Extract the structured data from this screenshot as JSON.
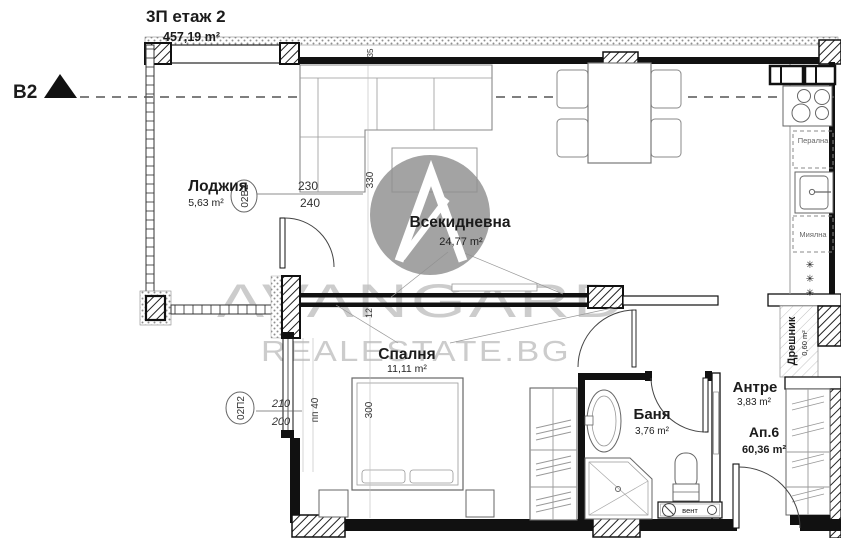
{
  "header": {
    "floor_label": "3П етаж 2",
    "floor_area": "457,19 m²"
  },
  "section_marker": {
    "label": "B2"
  },
  "watermark": {
    "brand": "AVANGARD",
    "site": "REALESTATE.BG"
  },
  "rooms": {
    "loggia": {
      "name": "Лоджия",
      "area": "5,63 m²"
    },
    "living": {
      "name": "Всекидневна",
      "area": "24,77 m²"
    },
    "bedroom": {
      "name": "Спалня",
      "area": "11,11 m²"
    },
    "bath": {
      "name": "Баня",
      "area": "3,76 m²"
    },
    "hall": {
      "name": "Антре",
      "area": "3,83 m²"
    },
    "closet": {
      "name": "Дрешник",
      "area": "0,60 m²"
    }
  },
  "apartment": {
    "number": "Ап.6",
    "total_area": "60,36 m²"
  },
  "appliances": {
    "washer": "Перална",
    "dishwasher": "Миялна",
    "vent": "вент"
  },
  "tags": {
    "loggia_window": "02В2",
    "bedroom_window": "02П2"
  },
  "dims": {
    "d230": "230",
    "d240": "240",
    "d210": "210",
    "d200": "200",
    "d330": "330",
    "d300": "300",
    "d12": "12",
    "d35": "35",
    "pp40": "пп 40"
  },
  "symbols": {
    "snowflake": "✳"
  }
}
